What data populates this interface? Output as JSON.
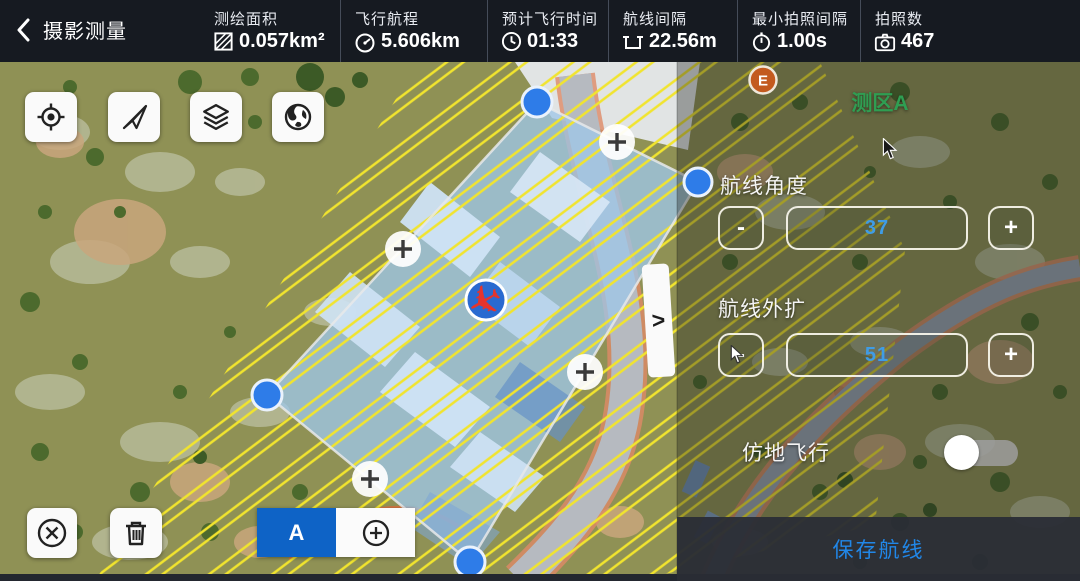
{
  "header": {
    "back_label": "摄影测量",
    "stats": [
      {
        "label": "测绘面积",
        "value": "0.057km²",
        "icon": "area-hatch-icon"
      },
      {
        "label": "飞行航程",
        "value": "5.606km",
        "icon": "gauge-icon"
      },
      {
        "label": "预计飞行时间",
        "value": "01:33",
        "icon": "clock-icon"
      },
      {
        "label": "航线间隔",
        "value": "22.56m",
        "icon": "interval-icon"
      },
      {
        "label": "最小拍照间隔",
        "value": "1.00s",
        "icon": "stopwatch-icon"
      },
      {
        "label": "拍照数",
        "value": "467",
        "icon": "camera-icon"
      }
    ]
  },
  "map": {
    "zone_label": "测区A",
    "e_marker": "E",
    "segment_a_label": "A",
    "tab_chevron": ">"
  },
  "panel": {
    "angle_label": "航线角度",
    "angle_value": "37",
    "extend_label": "航线外扩",
    "extend_value": "51",
    "minus": "-",
    "plus": "+",
    "terrain_label": "仿地飞行",
    "terrain_enabled": false,
    "save_label": "保存航线"
  },
  "icons": {
    "drone": "✈"
  },
  "colors": {
    "header_bg": "#161a21",
    "accent_blue": "#2187e8",
    "value_blue": "#3f9ce6",
    "zone_green": "#2f9e52",
    "strip_yellow": "#f1e42e",
    "vertex_blue": "#2e7ce8",
    "segment_blue": "#0e63c6"
  }
}
